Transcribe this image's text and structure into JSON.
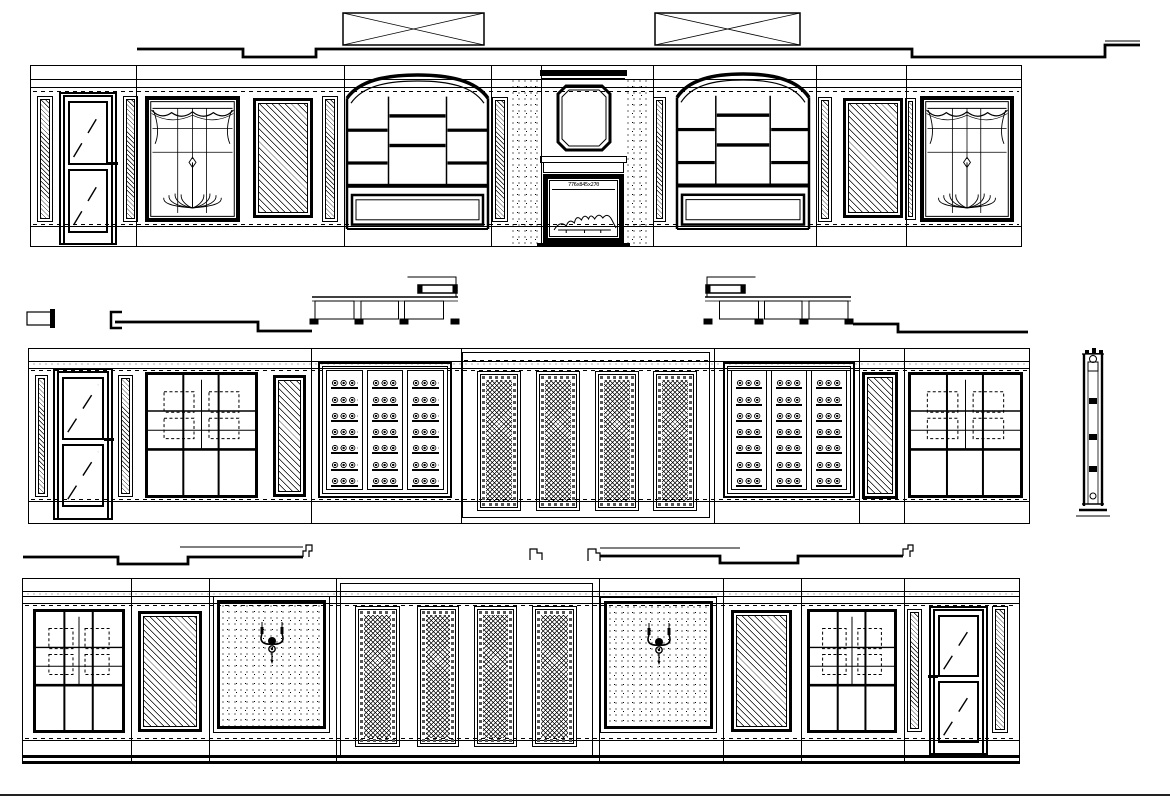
{
  "drawing": {
    "type": "interior-elevation-cad",
    "ink": "#000000",
    "paper": "#ffffff",
    "canvas": {
      "w": 1170,
      "h": 797
    }
  },
  "fireplace": {
    "label": "776x845x270"
  },
  "ceiling": {
    "profiles": [
      {
        "name": "top-ceiling-line",
        "d": "M137 49 H243 V57 H316 V49 H912 V57 H1105 V45 H1140",
        "w": 2.8
      },
      {
        "name": "top-ceiling-thin",
        "d": "M1105 41 H1140",
        "w": 1
      },
      {
        "name": "mid-left-line",
        "d": "M115 322 H258 V331 H312",
        "w": 2.8
      },
      {
        "name": "mid-right-line",
        "d": "M853 324 H898 V332 H1028",
        "w": 2.8
      },
      {
        "name": "bottom-left-thick",
        "d": "M23 557 H118 V564 H188 V557 H303",
        "w": 2.8
      },
      {
        "name": "bottom-left-thin",
        "d": "M180 547 H303",
        "w": 1
      },
      {
        "name": "bottom-left-hook",
        "d": "M303 557 V551 H306 V545 H312 V551 H309 V557",
        "w": 1.2
      },
      {
        "name": "bottom-mid-hook",
        "d": "M530 560 V549 H537 V553 H542 V560",
        "w": 1.2
      },
      {
        "name": "bottom-right-hook",
        "d": "M588 561 V549 H596 V553 H600 V561",
        "w": 1.2
      },
      {
        "name": "bottom-right-thin",
        "d": "M600 548 H740",
        "w": 1
      },
      {
        "name": "bottom-right-thick",
        "d": "M600 556 H720 V563 H798 V556 H903",
        "w": 2.8
      },
      {
        "name": "bottom-right-end-hook",
        "d": "M903 556 V549 H908 V545 H913 V551 H910 V557",
        "w": 1.2
      }
    ],
    "beams": [
      {
        "name": "ceiling-beam-left",
        "x": 343,
        "y": 13,
        "w": 141,
        "h": 32
      },
      {
        "name": "ceiling-beam-right",
        "x": 655,
        "y": 13,
        "w": 145,
        "h": 32
      }
    ],
    "brackets": [
      {
        "type": "rect-cap",
        "x": 27,
        "y": 312,
        "w": 26,
        "h": 13
      },
      {
        "type": "l-bracket",
        "x": 108,
        "y": 310,
        "w": 14,
        "h": 20
      }
    ],
    "soffits": [
      {
        "x": 310,
        "y": 272,
        "w": 150,
        "h": 58,
        "flip": false
      },
      {
        "x": 703,
        "y": 272,
        "w": 150,
        "h": 58,
        "flip": true
      }
    ]
  },
  "column_section": {
    "x": 1076,
    "y": 346,
    "w": 34,
    "h": 178
  },
  "page_edge": {
    "y": 794,
    "h": 2
  },
  "elevations": [
    {
      "id": "elevation-top",
      "x": 30,
      "y": 65,
      "w": 990,
      "h": 180,
      "frieze": [
        13,
        21
      ],
      "dash_top": 25,
      "dash_bottom": 158,
      "base_lines": [
        160
      ],
      "seams": [
        135,
        343,
        490,
        540,
        652,
        815,
        905
      ],
      "elements": [
        {
          "type": "pilaster",
          "x": 37,
          "y": 96,
          "w": 16,
          "h": 126
        },
        {
          "type": "door",
          "x": 59,
          "y": 92,
          "w": 58,
          "h": 153,
          "handle": "right"
        },
        {
          "type": "pilaster",
          "x": 123,
          "y": 96,
          "w": 15,
          "h": 126
        },
        {
          "type": "curtain-window",
          "x": 145,
          "y": 96,
          "w": 95,
          "h": 126
        },
        {
          "type": "hatch-panel",
          "x": 253,
          "y": 98,
          "w": 60,
          "h": 120
        },
        {
          "type": "pilaster",
          "x": 322,
          "y": 96,
          "w": 16,
          "h": 126
        },
        {
          "type": "arch-cabinet",
          "x": 345,
          "y": 71,
          "w": 145,
          "h": 160
        },
        {
          "type": "pilaster",
          "x": 492,
          "y": 97,
          "w": 16,
          "h": 125
        },
        {
          "type": "stipple-col",
          "x": 510,
          "y": 78,
          "w": 30,
          "h": 167
        },
        {
          "type": "fireplace",
          "x": 540,
          "y": 70,
          "w": 87,
          "h": 177
        },
        {
          "type": "stipple-col",
          "x": 625,
          "y": 78,
          "w": 25,
          "h": 167
        },
        {
          "type": "pilaster",
          "x": 653,
          "y": 97,
          "w": 13,
          "h": 125
        },
        {
          "type": "arch-cabinet",
          "x": 675,
          "y": 70,
          "w": 136,
          "h": 161
        },
        {
          "type": "pilaster",
          "x": 818,
          "y": 97,
          "w": 14,
          "h": 125
        },
        {
          "type": "hatch-panel",
          "x": 843,
          "y": 98,
          "w": 60,
          "h": 120
        },
        {
          "type": "pilaster",
          "x": 905,
          "y": 98,
          "w": 11,
          "h": 122
        },
        {
          "type": "curtain-window",
          "x": 920,
          "y": 96,
          "w": 94,
          "h": 126
        }
      ]
    },
    {
      "id": "elevation-middle",
      "x": 28,
      "y": 348,
      "w": 1000,
      "h": 174,
      "frieze": [
        12,
        19
      ],
      "dash_top": 21,
      "dash_bottom": 150,
      "base_lines": [
        152
      ],
      "texture_band": {
        "y": 12,
        "h": 8
      },
      "seams": [
        310,
        460,
        713,
        858,
        903
      ],
      "elements": [
        {
          "type": "pilaster",
          "x": 35,
          "y": 375,
          "w": 13,
          "h": 122
        },
        {
          "type": "door",
          "x": 53,
          "y": 368,
          "w": 60,
          "h": 152,
          "handle": "right"
        },
        {
          "type": "pilaster",
          "x": 118,
          "y": 375,
          "w": 15,
          "h": 122
        },
        {
          "type": "grid-window",
          "x": 145,
          "y": 372,
          "w": 113,
          "h": 126
        },
        {
          "type": "hatch-panel",
          "x": 273,
          "y": 375,
          "w": 33,
          "h": 122
        },
        {
          "type": "wine-rack",
          "x": 318,
          "y": 362,
          "w": 134,
          "h": 136
        },
        {
          "type": "bay-frame",
          "x": 462,
          "y": 352,
          "w": 248,
          "h": 166
        },
        {
          "type": "lattice-door",
          "x": 477,
          "y": 371,
          "w": 44,
          "h": 140
        },
        {
          "type": "lattice-door",
          "x": 536,
          "y": 371,
          "w": 44,
          "h": 140
        },
        {
          "type": "lattice-door",
          "x": 595,
          "y": 371,
          "w": 44,
          "h": 140
        },
        {
          "type": "lattice-door",
          "x": 653,
          "y": 371,
          "w": 44,
          "h": 140
        },
        {
          "type": "wine-rack",
          "x": 723,
          "y": 362,
          "w": 132,
          "h": 136
        },
        {
          "type": "hatch-panel",
          "x": 862,
          "y": 372,
          "w": 36,
          "h": 127
        },
        {
          "type": "grid-window",
          "x": 908,
          "y": 372,
          "w": 115,
          "h": 126
        }
      ]
    },
    {
      "id": "elevation-bottom",
      "x": 22,
      "y": 578,
      "w": 996,
      "h": 182,
      "frieze": [
        12,
        17,
        24
      ],
      "dash_top": 26,
      "dash_bottom": 159,
      "base_lines": [
        161
      ],
      "texture_band": {
        "y": 12,
        "h": 7
      },
      "floor": 176,
      "seams": [
        130,
        208,
        335,
        598,
        722,
        800,
        903
      ],
      "elements": [
        {
          "type": "grid-window",
          "x": 33,
          "y": 609,
          "w": 92,
          "h": 124
        },
        {
          "type": "hatch-panel",
          "x": 138,
          "y": 611,
          "w": 64,
          "h": 121
        },
        {
          "type": "sconce-panel",
          "x": 213,
          "y": 596,
          "w": 117,
          "h": 137
        },
        {
          "type": "bay-frame",
          "x": 340,
          "y": 583,
          "w": 253,
          "h": 175
        },
        {
          "type": "lattice-door",
          "x": 355,
          "y": 606,
          "w": 45,
          "h": 141
        },
        {
          "type": "lattice-door",
          "x": 417,
          "y": 606,
          "w": 42,
          "h": 141
        },
        {
          "type": "lattice-door",
          "x": 474,
          "y": 606,
          "w": 43,
          "h": 141
        },
        {
          "type": "lattice-door",
          "x": 532,
          "y": 606,
          "w": 45,
          "h": 141
        },
        {
          "type": "sconce-panel",
          "x": 600,
          "y": 597,
          "w": 117,
          "h": 136
        },
        {
          "type": "hatch-panel",
          "x": 731,
          "y": 610,
          "w": 61,
          "h": 122
        },
        {
          "type": "grid-window",
          "x": 807,
          "y": 609,
          "w": 90,
          "h": 124
        },
        {
          "type": "pilaster",
          "x": 907,
          "y": 609,
          "w": 15,
          "h": 123
        },
        {
          "type": "door",
          "x": 929,
          "y": 606,
          "w": 59,
          "h": 149,
          "handle": "left"
        },
        {
          "type": "pilaster",
          "x": 992,
          "y": 606,
          "w": 16,
          "h": 127
        }
      ]
    }
  ]
}
